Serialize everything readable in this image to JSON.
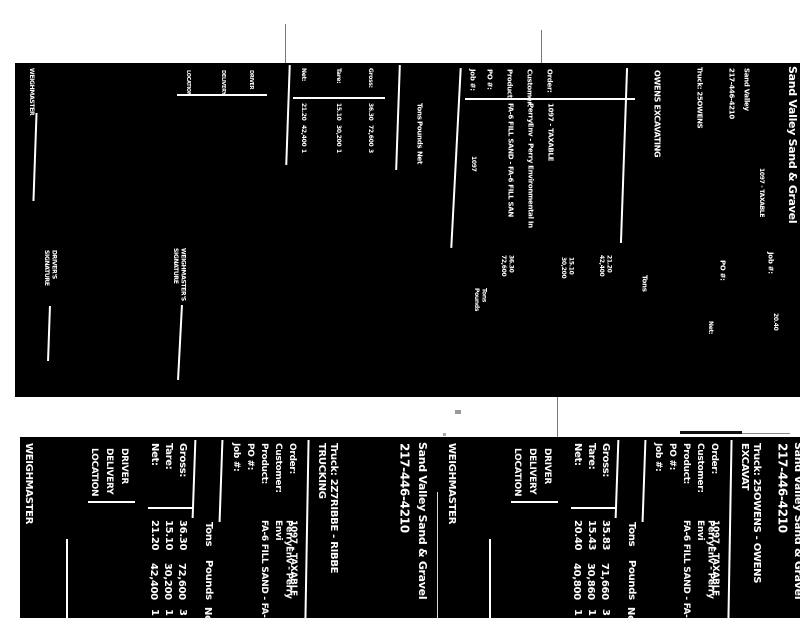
{
  "bl": {
    "company": "Sand Valley Sand & Gravel",
    "phone": "217-446-4210",
    "truck": "Truck: 2Z7RIBBE - RIBBE TRUCKING",
    "order_label": "Order:",
    "order_value": "1097 - TAXABLE",
    "customer_label": "Customer:",
    "customer_value": "PerryEnv - Perry Envi",
    "product_label": "Product:",
    "product_value": "FA-6 FILL SAND - FA-",
    "po_label": "PO #:",
    "job_label": "Job #:",
    "col_tons": "Tons",
    "col_pounds": "Pounds",
    "col_net_partial": "Net",
    "gross_label": "Gross:",
    "tare_label": "Tare:",
    "net_label": "Net:",
    "gross_tons": "36.30",
    "tare_tons": "15.10",
    "net_tons": "21.20",
    "gross_pounds": "72,600",
    "tare_pounds": "30,200",
    "net_pounds": "42,400",
    "gross_extra": "3",
    "tare_extra": "1",
    "net_extra": "1",
    "driver": "DRIVER",
    "delivery": "DELIVERY",
    "location": "LOCATION",
    "weighmaster": "WEIGHMASTER"
  },
  "br": {
    "company": "Sand Valley Sand & Gravel",
    "phone": "217-446-4210",
    "truck": "Truck: 25OWENS - OWENS EXCAVAT",
    "order_label": "Order:",
    "order_value": "1097 - TAXABLE",
    "customer_label": "Customer:",
    "customer_value": "PerryEnv - Perry Envi",
    "product_label": "Product:",
    "product_value": "FA-6 FILL SAND - FA-",
    "po_label": "PO #:",
    "job_label": "Job #:",
    "col_tons": "Tons",
    "col_pounds": "Pounds",
    "col_net_partial": "Net",
    "gross_label": "Gross:",
    "tare_label": "Tare:",
    "net_label": "Net:",
    "gross_tons": "35.83",
    "tare_tons": "15.43",
    "net_tons": "20.40",
    "gross_pounds": "71,660",
    "tare_pounds": "30,860",
    "net_pounds": "40,800",
    "gross_extra": "3",
    "tare_extra": "1",
    "net_extra": "1",
    "driver": "DRIVER",
    "delivery": "DELIVERY",
    "location": "LOCATION",
    "weighmaster": "WEIGHMASTER"
  },
  "tp": {
    "weighmaster": "WEIGHMASTER",
    "drivers_signature": "DRIVER'S\nSIGNATURE",
    "weighmasters_signature": "WEIGHMASTER'S\nSIGNATURE",
    "location": "LOCATION",
    "delivery": "DELIVERY",
    "driver": "DRIVER",
    "gross_label": "Gross:",
    "tare_label": "Tare:",
    "net_label": "Net:",
    "gross_tons": "36.30",
    "tare_tons": "15.10",
    "net_tons": "21.20",
    "gross_pounds": "72,600",
    "tare_pounds": "30,200",
    "net_pounds": "42,400",
    "gross_extra": "3",
    "tare_extra": "1",
    "net_extra": "1",
    "col_tons": "Tons",
    "col_pounds": "Pounds",
    "col_net": "Net",
    "job_label": "Job #:",
    "po_label": "PO #:",
    "product_label": "Product:",
    "customer_label": "Customer:",
    "order_label": "Order:",
    "job_value": "1097",
    "order_value": "1097 - TAXABLE",
    "customer_value": "PerryEnv - Perry Environmental In",
    "product_value": "FA-6 FILL SAND - FA-6 FILL SAN",
    "truck_owner": "OWENS EXCAVATING",
    "truck": "Truck: 25OWENS",
    "phone": "217-446-4210",
    "company_short": "Sand Valley",
    "company_cut": "Sand Valley Sand & Gravel",
    "ref_value": "1097 - TAXABLE",
    "po2": "PO #:",
    "job2": "Job #:",
    "tons2": "Tons",
    "net2": "Net:",
    "net2_val": "20.40",
    "blk1": "Tons\nPounds",
    "blk2": "36.30\n72,600",
    "blk3": "15.10\n30,200",
    "blk4": "21.20\n42,400"
  }
}
